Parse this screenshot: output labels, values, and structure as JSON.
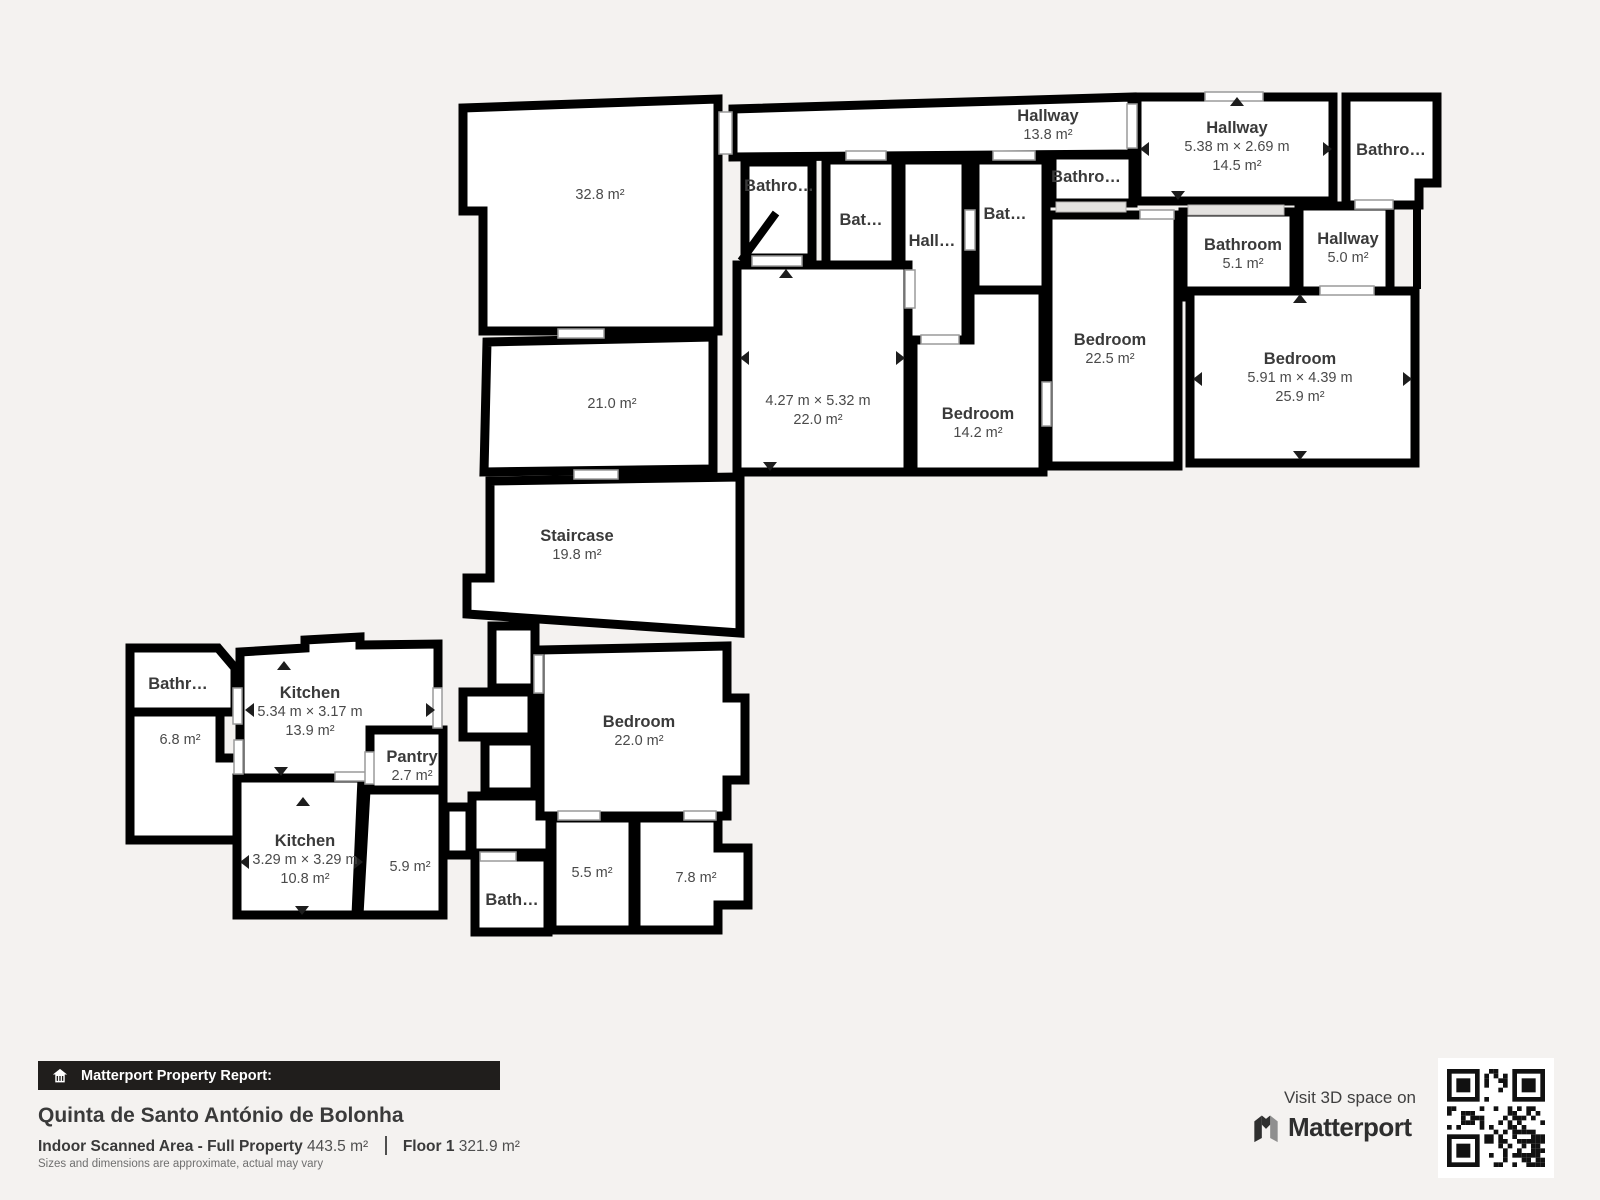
{
  "floorplan": {
    "rooms": [
      {
        "id": "room-32-8",
        "area": "32.8 m²"
      },
      {
        "id": "room-21-0",
        "area": "21.0 m²"
      },
      {
        "id": "staircase",
        "name": "Staircase",
        "area": "19.8 m²"
      },
      {
        "id": "hallway-13-8",
        "name": "Hallway",
        "area": "13.8 m²"
      },
      {
        "id": "hallway-14-5",
        "name": "Hallway",
        "dims": "5.38 m × 2.69 m",
        "area": "14.5 m²"
      },
      {
        "id": "bathroom-top-right",
        "name": "Bathro…"
      },
      {
        "id": "bathroom-a",
        "name": "Bathro…"
      },
      {
        "id": "bathroom-b",
        "name": "Bat…"
      },
      {
        "id": "hall-c",
        "name": "Hall…"
      },
      {
        "id": "bathroom-d",
        "name": "Bat…"
      },
      {
        "id": "bathroom-e",
        "name": "Bathro…"
      },
      {
        "id": "bathroom-5-1",
        "name": "Bathroom",
        "area": "5.1 m²"
      },
      {
        "id": "hallway-5-0",
        "name": "Hallway",
        "area": "5.0 m²"
      },
      {
        "id": "room-22-0",
        "dims": "4.27 m × 5.32 m",
        "area": "22.0 m²"
      },
      {
        "id": "bedroom-14-2",
        "name": "Bedroom",
        "area": "14.2 m²"
      },
      {
        "id": "bedroom-22-5",
        "name": "Bedroom",
        "area": "22.5 m²"
      },
      {
        "id": "bedroom-25-9",
        "name": "Bedroom",
        "dims": "5.91 m × 4.39 m",
        "area": "25.9 m²"
      },
      {
        "id": "bathroom-small-left",
        "name": "Bathr…"
      },
      {
        "id": "room-6-8",
        "area": "6.8 m²"
      },
      {
        "id": "kitchen-13-9",
        "name": "Kitchen",
        "dims": "5.34 m × 3.17 m",
        "area": "13.9 m²"
      },
      {
        "id": "pantry",
        "name": "Pantry",
        "area": "2.7 m²"
      },
      {
        "id": "kitchen-10-8",
        "name": "Kitchen",
        "dims": "3.29 m × 3.29 m",
        "area": "10.8 m²"
      },
      {
        "id": "room-5-9",
        "area": "5.9 m²"
      },
      {
        "id": "bath-small-center",
        "name": "Bath…"
      },
      {
        "id": "room-5-5",
        "area": "5.5 m²"
      },
      {
        "id": "room-7-8",
        "area": "7.8 m²"
      },
      {
        "id": "bedroom-22-0b",
        "name": "Bedroom",
        "area": "22.0 m²"
      }
    ]
  },
  "footer": {
    "report_label": "Matterport Property Report:",
    "property_name": "Quinta de Santo António de Bolonha",
    "scanned_area_label": "Indoor Scanned Area - Full Property",
    "scanned_area_value": "443.5 m²",
    "floor_label": "Floor 1",
    "floor_value": "321.9 m²",
    "disclaimer": "Sizes and dimensions are approximate, actual may vary"
  },
  "cta": {
    "visit_label": "Visit 3D space on",
    "brand": "Matterport"
  },
  "colors": {
    "background": "#f4f2f0",
    "walls": "#000000",
    "room_fill": "#ffffff",
    "label_text": "#3a3a3a",
    "bar_background": "#201e1c"
  }
}
